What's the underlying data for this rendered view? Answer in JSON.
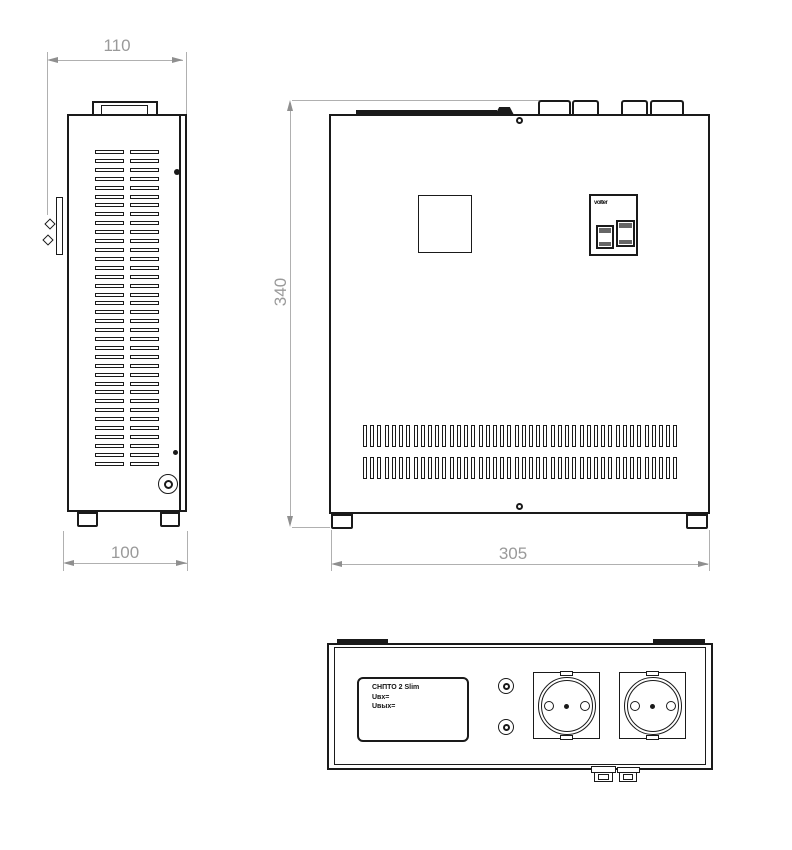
{
  "side_view": {
    "dim_top": {
      "value": "110"
    },
    "dim_bottom": {
      "value": "100"
    },
    "vents": {
      "columns": 2,
      "slots_per_column": 36
    }
  },
  "front_view": {
    "dim_height": {
      "value": "340"
    },
    "dim_width": {
      "value": "305"
    },
    "breaker": {
      "brand_label": "volter",
      "switch_count": 2
    },
    "vents": {
      "rows": 2,
      "slots_per_row": 44
    }
  },
  "bottom_view": {
    "nameplate": {
      "line1": "СНПТО 2 Slim",
      "line2": "Uвх=",
      "line3": "Uвых="
    },
    "socket_count": 2,
    "indicator_count": 2
  },
  "colors": {
    "line": "#1a1a1a",
    "dim_line": "#b0b0b0",
    "dim_text": "#9a9a9a",
    "background": "#ffffff"
  }
}
